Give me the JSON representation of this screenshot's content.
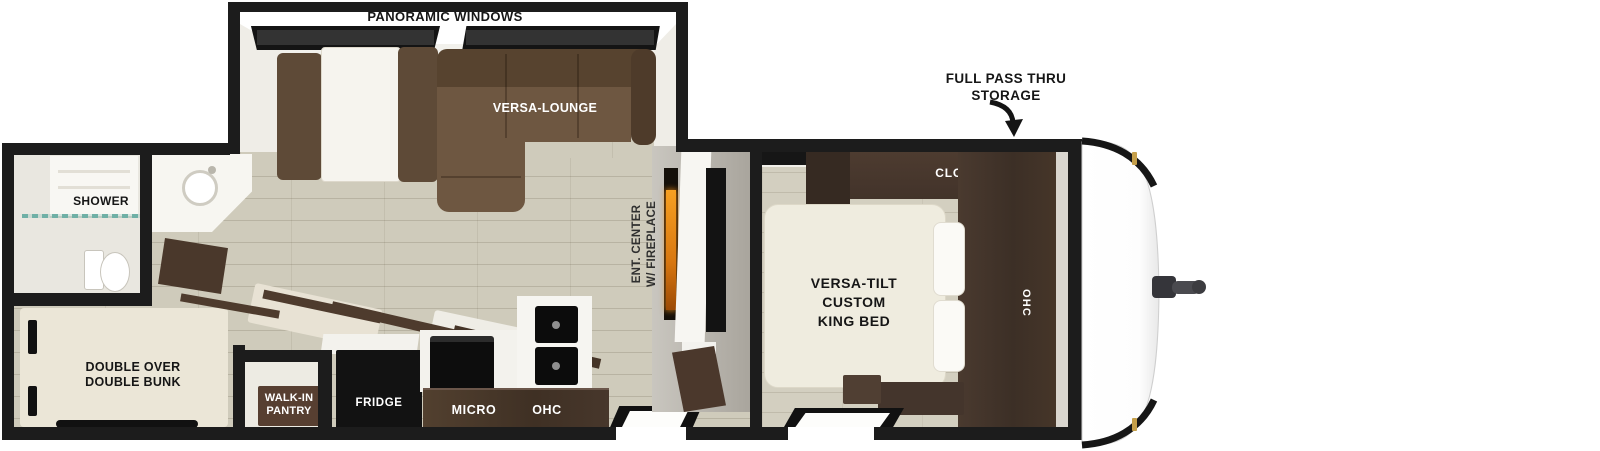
{
  "floorplan": {
    "slideout": {
      "windows_label": "PANORAMIC WINDOWS",
      "lounge_label": "VERSA-LOUNGE"
    },
    "storage_callout": {
      "line1": "FULL PASS THRU",
      "line2": "STORAGE"
    },
    "bedroom": {
      "closet_label": "CLOSET",
      "ohc_label": "OHC",
      "bed_label": {
        "line1": "VERSA-TILT",
        "line2": "CUSTOM",
        "line3": "KING BED"
      }
    },
    "entertainment": {
      "line1": "ENT. CENTER",
      "line2": "W/ FIREPLACE"
    },
    "bathroom": {
      "shower_label": "SHOWER"
    },
    "bunk_room": {
      "line1": "DOUBLE OVER",
      "line2": "DOUBLE BUNK"
    },
    "pantry": {
      "line1": "WALK-IN",
      "line2": "PANTRY"
    },
    "kitchen": {
      "fridge_label": "FRIDGE",
      "micro_label": "MICRO",
      "ohc_label": "OHC"
    },
    "colors": {
      "wall": "#1c1c1c",
      "floor_plank": "#cfcbbb",
      "sofa_brown": "#6e5741",
      "cabinet_dark": "#4a392e",
      "bed_cream": "#efecdf",
      "bunk_cream": "#ebe6d7",
      "pantry_sign": "#573f31",
      "fireplace_flame": "#f59b1f",
      "shower_glass": "#6fb0a6",
      "hinge_gold": "#c59f4a",
      "hitch_gray": "#3c3c40"
    }
  }
}
